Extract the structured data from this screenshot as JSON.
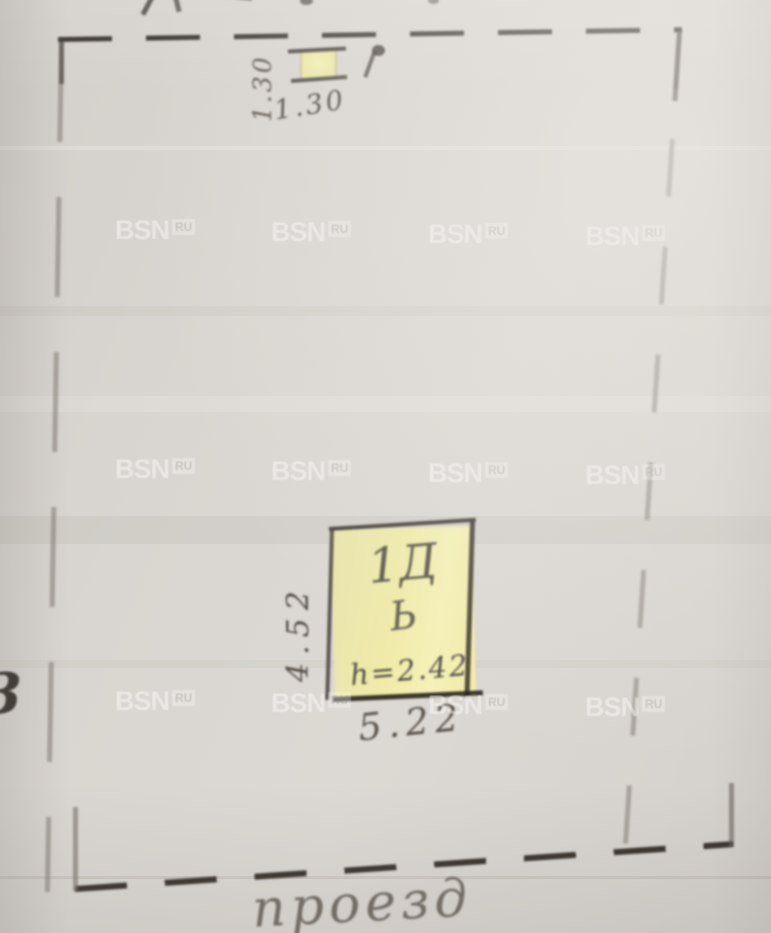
{
  "watermark": {
    "brand": "BSN",
    "region": "RU"
  },
  "plan": {
    "small_structure": {
      "side_label": "1.30",
      "bottom_label": "1.30"
    },
    "main_structure": {
      "designation": "1Д",
      "letter": "Ь",
      "height_note": "h=2.42",
      "width_label": "5.22",
      "depth_label": "4.52"
    },
    "road_label": "проезд",
    "left_edge_mark": "3"
  },
  "colors": {
    "paper": "#d9d5d0",
    "ink": "#38322c",
    "pencil": "#8f8982",
    "highlight": "#f0eba8",
    "watermark": "#ffffff"
  }
}
